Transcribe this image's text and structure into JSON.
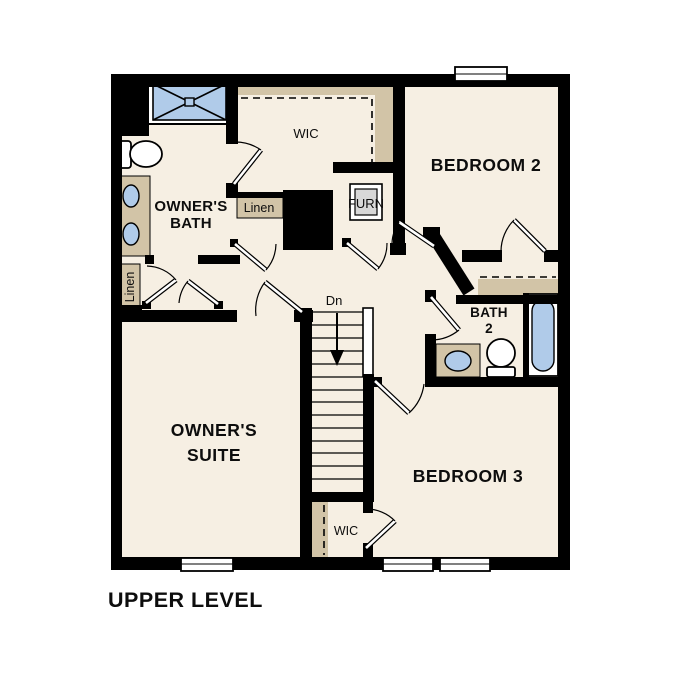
{
  "plan": {
    "title": "UPPER LEVEL",
    "level": "Upper Level floor plan",
    "rooms": {
      "owners_bath": {
        "line1": "OWNER'S",
        "line2": "BATH"
      },
      "wic_upper": {
        "label": "WIC"
      },
      "linen_upper": {
        "label": "Linen"
      },
      "furnace": {
        "label": "FURN"
      },
      "bedroom2": {
        "label": "BEDROOM 2"
      },
      "bath2": {
        "line1": "BATH",
        "line2": "2"
      },
      "linen_side": {
        "label": "Linen"
      },
      "owners_suite": {
        "line1": "OWNER'S",
        "line2": "SUITE"
      },
      "bedroom3": {
        "label": "BEDROOM 3"
      },
      "wic_lower": {
        "label": "WIC"
      },
      "stairs": {
        "direction_label": "Dn"
      }
    },
    "colors": {
      "wall": "#000000",
      "floor": "#f6efe3",
      "cabinet_tan": "#d2c4a7",
      "fixture_blue": "#b0cbe9",
      "furnace_gray": "#d8d8d8",
      "background": "#ffffff"
    }
  }
}
